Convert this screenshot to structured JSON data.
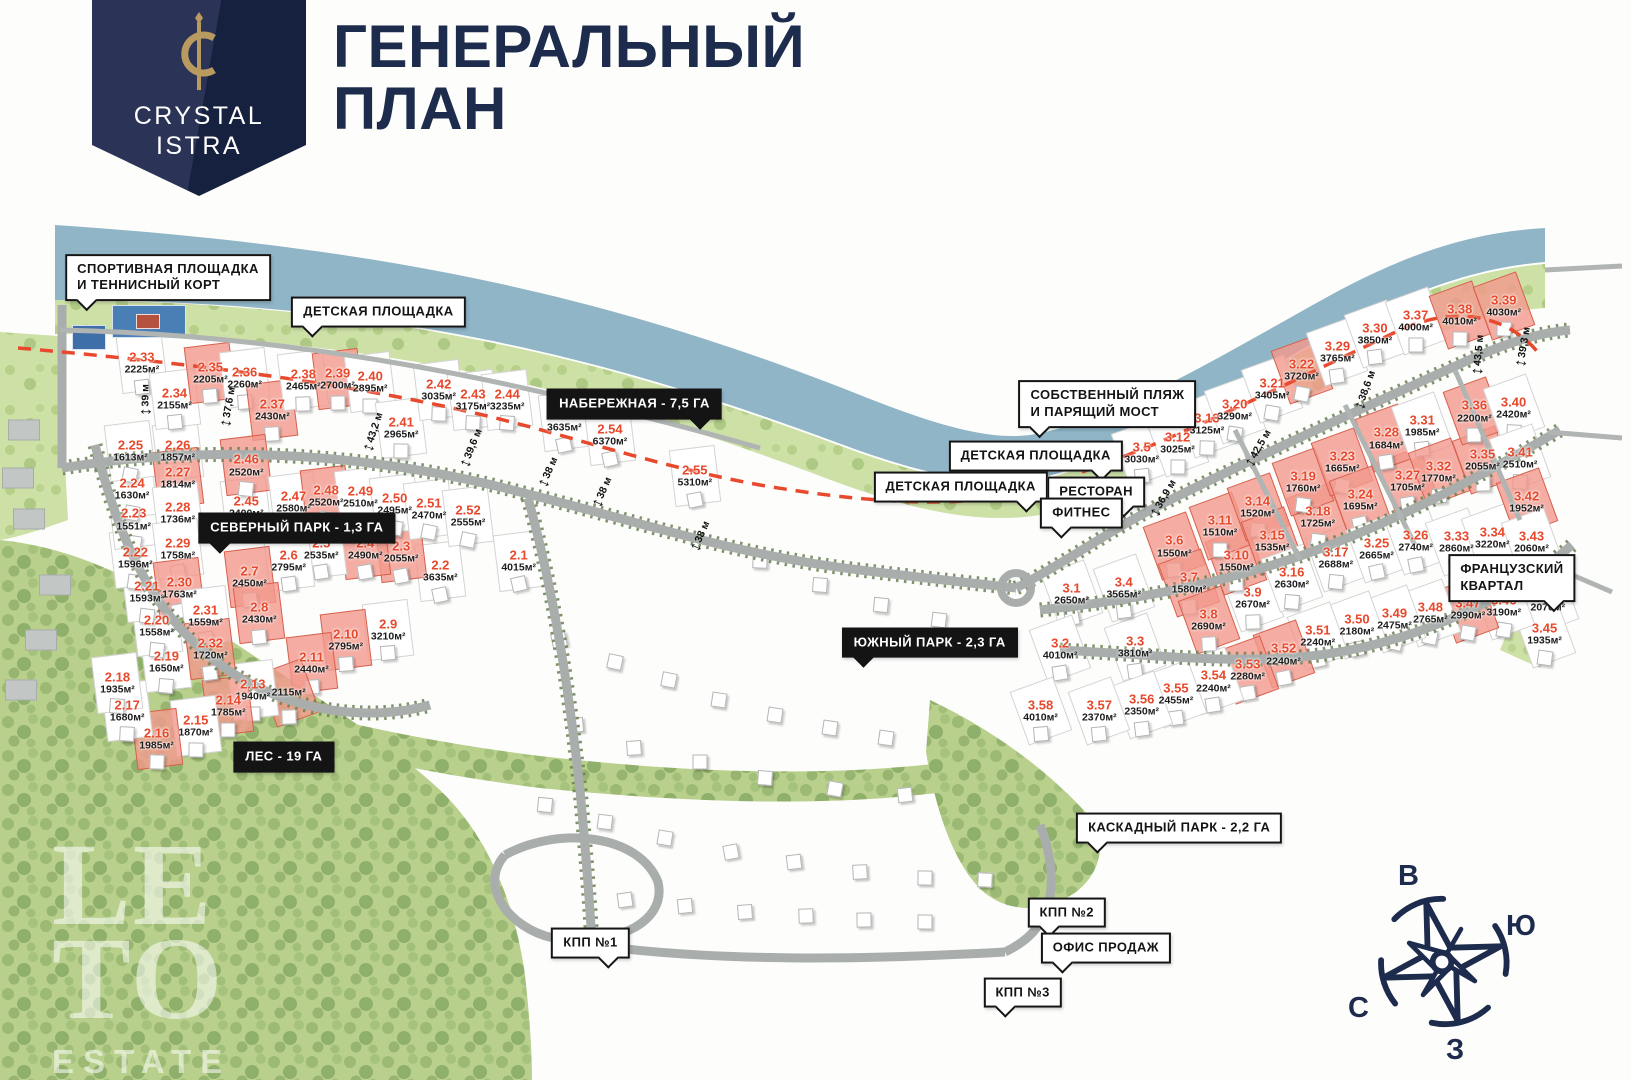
{
  "header": {
    "logo_line1": "CRYSTAL",
    "logo_line2": "ISTRA",
    "title_line1": "ГЕНЕРАЛЬНЫЙ",
    "title_line2": "ПЛАН"
  },
  "watermark": {
    "line1": "LE",
    "line2": "TO",
    "line3": "ESTATE"
  },
  "compass": {
    "top": "В",
    "right": "Ю",
    "left": "С",
    "bottom": "З"
  },
  "colors": {
    "navy": "#1d2b4d",
    "accent_red": "#e8482b",
    "sold_pink": "#f2988c",
    "water": "#8fb5c6",
    "forest": "#b7cf8c",
    "road": "#a9aeac",
    "label_black": "#141414"
  },
  "callouts": [
    {
      "text": "СПОРТИВНАЯ ПЛОЩАДКА\nИ ТЕННИСНЫЙ КОРТ",
      "x": 10.3,
      "y": 25.7,
      "style": "light",
      "pointer": "dl"
    },
    {
      "text": "ДЕТСКАЯ ПЛОЩАДКА",
      "x": 23.2,
      "y": 28.9,
      "style": "light",
      "pointer": "dl"
    },
    {
      "text": "НАБЕРЕЖНАЯ - 7,5 ГА",
      "x": 38.9,
      "y": 37.4,
      "style": "dark",
      "pointer": "dr"
    },
    {
      "text": "СЕВЕРНЫЙ ПАРК - 1,3 ГА",
      "x": 18.2,
      "y": 48.9,
      "style": "dark",
      "pointer": "dl"
    },
    {
      "text": "СОБСТВЕННЫЙ ПЛЯЖ\nИ ПАРЯЩИЙ МОСТ",
      "x": 67.9,
      "y": 37.4,
      "style": "light",
      "pointer": "dl"
    },
    {
      "text": "ДЕТСКАЯ ПЛОЩАДКА",
      "x": 63.5,
      "y": 42.2,
      "style": "light",
      "pointer": "dr"
    },
    {
      "text": "ДЕТСКАЯ ПЛОЩАДКА",
      "x": 58.9,
      "y": 45.1,
      "style": "light",
      "pointer": "dr"
    },
    {
      "text": "РЕСТОРАН",
      "x": 67.2,
      "y": 45.6,
      "style": "light",
      "pointer": "dr"
    },
    {
      "text": "ФИТНЕС",
      "x": 66.3,
      "y": 47.5,
      "style": "light",
      "pointer": "dl"
    },
    {
      "text": "ЮЖНЫЙ ПАРК - 2,3 ГА",
      "x": 57.0,
      "y": 59.5,
      "style": "dark",
      "pointer": "dl"
    },
    {
      "text": "ФРАНЦУЗСКИЙ КВАРТАЛ",
      "x": 92.7,
      "y": 53.5,
      "style": "light",
      "pointer": "dr"
    },
    {
      "text": "ЛЕС - 19 ГА",
      "x": 17.4,
      "y": 70.1,
      "style": "dark",
      "pointer": ""
    },
    {
      "text": "КАСКАДНЫЙ ПАРК - 2,2 ГА",
      "x": 72.3,
      "y": 76.7,
      "style": "light",
      "pointer": "dl"
    },
    {
      "text": "КПП №2",
      "x": 65.4,
      "y": 84.5,
      "style": "light",
      "pointer": "dl"
    },
    {
      "text": "ОФИС ПРОДАЖ",
      "x": 67.8,
      "y": 87.8,
      "style": "light",
      "pointer": "dl"
    },
    {
      "text": "КПП №3",
      "x": 62.7,
      "y": 91.9,
      "style": "light",
      "pointer": "dl"
    },
    {
      "text": "КПП №1",
      "x": 36.2,
      "y": 87.3,
      "style": "light",
      "pointer": "dr"
    }
  ],
  "dimensions": [
    {
      "text": "39 м",
      "x": 8.9,
      "y": 37.0,
      "angle": -90
    },
    {
      "text": "37,6 м",
      "x": 14.0,
      "y": 37.7,
      "angle": -80
    },
    {
      "text": "43,2 м",
      "x": 22.9,
      "y": 40.0,
      "angle": -72
    },
    {
      "text": "39,6 м",
      "x": 28.9,
      "y": 41.5,
      "angle": -68
    },
    {
      "text": "38 м",
      "x": 33.6,
      "y": 43.7,
      "angle": -66
    },
    {
      "text": "38 м",
      "x": 36.9,
      "y": 45.6,
      "angle": -66
    },
    {
      "text": "38 м",
      "x": 42.9,
      "y": 49.6,
      "angle": -66
    },
    {
      "text": "38,6 м",
      "x": 83.7,
      "y": 36.1,
      "angle": -70
    },
    {
      "text": "42,5 м",
      "x": 77.1,
      "y": 41.5,
      "angle": -60
    },
    {
      "text": "36,9 м",
      "x": 71.3,
      "y": 46.1,
      "angle": -60
    },
    {
      "text": "43,5 м",
      "x": 90.6,
      "y": 32.9,
      "angle": -85
    },
    {
      "text": "39,3 м",
      "x": 93.4,
      "y": 32.1,
      "angle": -80
    }
  ],
  "plots": [
    {
      "id": "2.1",
      "area": "4015м²",
      "x": 31.8,
      "y": 51.9,
      "sold": false
    },
    {
      "id": "2.2",
      "area": "3635м²",
      "x": 27.0,
      "y": 52.9,
      "sold": false
    },
    {
      "id": "2.3",
      "area": "2055м²",
      "x": 24.6,
      "y": 51.1,
      "sold": true
    },
    {
      "id": "2.4",
      "area": "2490м²",
      "x": 22.4,
      "y": 50.8,
      "sold": true
    },
    {
      "id": "2.5",
      "area": "2535м²",
      "x": 19.7,
      "y": 50.8,
      "sold": false
    },
    {
      "id": "2.6",
      "area": "2795м²",
      "x": 17.7,
      "y": 51.9,
      "sold": false
    },
    {
      "id": "2.7",
      "area": "2450м²",
      "x": 15.3,
      "y": 53.4,
      "sold": true
    },
    {
      "id": "2.8",
      "area": "2430м²",
      "x": 15.9,
      "y": 56.8,
      "sold": true
    },
    {
      "id": "2.9",
      "area": "3210м²",
      "x": 23.8,
      "y": 58.3,
      "sold": false
    },
    {
      "id": "2.10",
      "area": "2795м²",
      "x": 21.2,
      "y": 59.3,
      "sold": true
    },
    {
      "id": "2.11",
      "area": "2440м²",
      "x": 19.1,
      "y": 61.4,
      "sold": true
    },
    {
      "id": "",
      "area": "2115м²",
      "x": 17.7,
      "y": 64.2,
      "sold": true
    },
    {
      "id": "2.13",
      "area": "1940м²",
      "x": 15.5,
      "y": 63.9,
      "sold": false
    },
    {
      "id": "2.14",
      "area": "1785м²",
      "x": 14.0,
      "y": 65.4,
      "sold": true
    },
    {
      "id": "2.15",
      "area": "1870м²",
      "x": 12.0,
      "y": 67.2,
      "sold": false
    },
    {
      "id": "2.16",
      "area": "1985м²",
      "x": 9.6,
      "y": 68.4,
      "sold": true
    },
    {
      "id": "2.17",
      "area": "1680м²",
      "x": 7.8,
      "y": 65.8,
      "sold": false
    },
    {
      "id": "2.18",
      "area": "1935м²",
      "x": 7.2,
      "y": 63.2,
      "sold": false
    },
    {
      "id": "2.19",
      "area": "1650м²",
      "x": 10.2,
      "y": 61.3,
      "sold": false
    },
    {
      "id": "2.20",
      "area": "1558м²",
      "x": 9.6,
      "y": 58.0,
      "sold": false
    },
    {
      "id": "2.21",
      "area": "1593м²",
      "x": 9.0,
      "y": 54.8,
      "sold": false
    },
    {
      "id": "2.22",
      "area": "1596м²",
      "x": 8.3,
      "y": 51.7,
      "sold": false
    },
    {
      "id": "2.23",
      "area": "1551м²",
      "x": 8.2,
      "y": 48.1,
      "sold": false
    },
    {
      "id": "2.24",
      "area": "1630м²",
      "x": 8.1,
      "y": 45.3,
      "sold": false
    },
    {
      "id": "2.25",
      "area": "1613м²",
      "x": 8.0,
      "y": 41.8,
      "sold": false
    },
    {
      "id": "2.26",
      "area": "1857м²",
      "x": 10.9,
      "y": 41.8,
      "sold": false
    },
    {
      "id": "2.27",
      "area": "1814м²",
      "x": 10.9,
      "y": 44.3,
      "sold": true
    },
    {
      "id": "2.28",
      "area": "1736м²",
      "x": 10.9,
      "y": 47.5,
      "sold": false
    },
    {
      "id": "2.29",
      "area": "1758м²",
      "x": 10.9,
      "y": 50.8,
      "sold": false
    },
    {
      "id": "2.30",
      "area": "1763м²",
      "x": 11.0,
      "y": 54.4,
      "sold": true
    },
    {
      "id": "2.31",
      "area": "1559м²",
      "x": 12.6,
      "y": 57.0,
      "sold": false
    },
    {
      "id": "2.32",
      "area": "1720м²",
      "x": 12.9,
      "y": 60.1,
      "sold": true
    },
    {
      "id": "2.33",
      "area": "2225м²",
      "x": 8.7,
      "y": 33.6,
      "sold": false
    },
    {
      "id": "2.34",
      "area": "2155м²",
      "x": 10.7,
      "y": 36.9,
      "sold": false
    },
    {
      "id": "2.35",
      "area": "2205м²",
      "x": 12.9,
      "y": 34.5,
      "sold": true
    },
    {
      "id": "2.36",
      "area": "2260м²",
      "x": 15.0,
      "y": 35.0,
      "sold": false
    },
    {
      "id": "2.37",
      "area": "2430м²",
      "x": 16.7,
      "y": 38.0,
      "sold": true
    },
    {
      "id": "2.38",
      "area": "2465м²",
      "x": 18.6,
      "y": 35.2,
      "sold": false
    },
    {
      "id": "2.39",
      "area": "2700м²",
      "x": 20.7,
      "y": 35.1,
      "sold": true
    },
    {
      "id": "2.40",
      "area": "2895м²",
      "x": 22.7,
      "y": 35.4,
      "sold": false
    },
    {
      "id": "2.41",
      "area": "2965м²",
      "x": 24.6,
      "y": 39.6,
      "sold": false
    },
    {
      "id": "2.42",
      "area": "3035м²",
      "x": 26.9,
      "y": 36.1,
      "sold": false
    },
    {
      "id": "2.43",
      "area": "3175м²",
      "x": 29.0,
      "y": 37.0,
      "sold": false
    },
    {
      "id": "2.44",
      "area": "3235м²",
      "x": 31.1,
      "y": 37.0,
      "sold": false
    },
    {
      "id": "2.45",
      "area": "2400м²",
      "x": 15.1,
      "y": 46.9,
      "sold": false
    },
    {
      "id": "2.46",
      "area": "2520м²",
      "x": 15.1,
      "y": 43.1,
      "sold": true
    },
    {
      "id": "2.47",
      "area": "2580м²",
      "x": 18.0,
      "y": 46.5,
      "sold": false
    },
    {
      "id": "2.48",
      "area": "2520м²",
      "x": 20.0,
      "y": 45.9,
      "sold": true
    },
    {
      "id": "2.49",
      "area": "2510м²",
      "x": 22.1,
      "y": 46.0,
      "sold": false
    },
    {
      "id": "2.50",
      "area": "2495м²",
      "x": 24.2,
      "y": 46.7,
      "sold": false
    },
    {
      "id": "2.51",
      "area": "2470м²",
      "x": 26.3,
      "y": 47.1,
      "sold": false
    },
    {
      "id": "2.52",
      "area": "2555м²",
      "x": 28.7,
      "y": 47.8,
      "sold": false
    },
    {
      "id": "2.53",
      "area": "3635м²",
      "x": 34.6,
      "y": 39.0,
      "sold": false
    },
    {
      "id": "2.54",
      "area": "6370м²",
      "x": 37.4,
      "y": 40.3,
      "sold": false
    },
    {
      "id": "2.55",
      "area": "5310м²",
      "x": 42.6,
      "y": 44.1,
      "sold": false
    },
    {
      "id": "3.1",
      "area": "2650м²",
      "x": 65.7,
      "y": 55.0,
      "sold": false
    },
    {
      "id": "3.2",
      "area": "4010м²",
      "x": 65.0,
      "y": 60.1,
      "sold": false
    },
    {
      "id": "3.3",
      "area": "3810м²",
      "x": 69.6,
      "y": 59.9,
      "sold": false
    },
    {
      "id": "3.4",
      "area": "3565м²",
      "x": 68.9,
      "y": 54.4,
      "sold": false
    },
    {
      "id": "3.5",
      "area": "3030м²",
      "x": 70.0,
      "y": 41.9,
      "sold": false
    },
    {
      "id": "3.6",
      "area": "1550м²",
      "x": 72.0,
      "y": 50.6,
      "sold": true
    },
    {
      "id": "3.7",
      "area": "1580м²",
      "x": 72.9,
      "y": 54.0,
      "sold": true
    },
    {
      "id": "3.8",
      "area": "2690м²",
      "x": 74.1,
      "y": 57.4,
      "sold": true
    },
    {
      "id": "3.9",
      "area": "2670м²",
      "x": 76.8,
      "y": 55.4,
      "sold": false
    },
    {
      "id": "3.10",
      "area": "1550м²",
      "x": 75.8,
      "y": 51.9,
      "sold": true
    },
    {
      "id": "3.11",
      "area": "1510м²",
      "x": 74.8,
      "y": 48.7,
      "sold": true
    },
    {
      "id": "3.12",
      "area": "3025м²",
      "x": 72.2,
      "y": 41.0,
      "sold": false
    },
    {
      "id": "3.13",
      "area": "3125м²",
      "x": 74.0,
      "y": 39.3,
      "sold": false
    },
    {
      "id": "3.14",
      "area": "1520м²",
      "x": 77.1,
      "y": 46.9,
      "sold": true
    },
    {
      "id": "3.15",
      "area": "1535м²",
      "x": 78.0,
      "y": 50.1,
      "sold": true
    },
    {
      "id": "3.16",
      "area": "2630м²",
      "x": 79.2,
      "y": 53.5,
      "sold": false
    },
    {
      "id": "3.17",
      "area": "2688м²",
      "x": 81.9,
      "y": 51.7,
      "sold": false
    },
    {
      "id": "3.18",
      "area": "1725м²",
      "x": 80.8,
      "y": 47.9,
      "sold": true
    },
    {
      "id": "3.19",
      "area": "1760м²",
      "x": 79.9,
      "y": 44.6,
      "sold": true
    },
    {
      "id": "3.20",
      "area": "3290м²",
      "x": 75.7,
      "y": 38.0,
      "sold": false
    },
    {
      "id": "3.21",
      "area": "3405м²",
      "x": 78.0,
      "y": 36.0,
      "sold": false
    },
    {
      "id": "3.22",
      "area": "3720м²",
      "x": 79.8,
      "y": 34.3,
      "sold": true
    },
    {
      "id": "3.23",
      "area": "1665м²",
      "x": 82.3,
      "y": 42.8,
      "sold": true
    },
    {
      "id": "3.24",
      "area": "1695м²",
      "x": 83.4,
      "y": 46.3,
      "sold": true
    },
    {
      "id": "3.25",
      "area": "2665м²",
      "x": 84.4,
      "y": 50.8,
      "sold": false
    },
    {
      "id": "3.26",
      "area": "2740м²",
      "x": 86.8,
      "y": 50.1,
      "sold": false
    },
    {
      "id": "3.27",
      "area": "1705м²",
      "x": 86.3,
      "y": 44.5,
      "sold": true
    },
    {
      "id": "3.28",
      "area": "1684м²",
      "x": 85.0,
      "y": 40.6,
      "sold": true
    },
    {
      "id": "3.29",
      "area": "3765м²",
      "x": 82.0,
      "y": 32.6,
      "sold": false
    },
    {
      "id": "3.30",
      "area": "3850м²",
      "x": 84.3,
      "y": 30.9,
      "sold": false
    },
    {
      "id": "3.31",
      "area": "1985м²",
      "x": 87.2,
      "y": 39.4,
      "sold": false
    },
    {
      "id": "3.32",
      "area": "1770м²",
      "x": 88.2,
      "y": 43.7,
      "sold": true
    },
    {
      "id": "3.33",
      "area": "2860м²",
      "x": 89.3,
      "y": 50.2,
      "sold": false
    },
    {
      "id": "3.34",
      "area": "3220м²",
      "x": 91.5,
      "y": 49.8,
      "sold": false
    },
    {
      "id": "3.35",
      "area": "2055м²",
      "x": 90.9,
      "y": 42.6,
      "sold": true
    },
    {
      "id": "3.36",
      "area": "2200м²",
      "x": 90.4,
      "y": 38.1,
      "sold": true
    },
    {
      "id": "3.37",
      "area": "4000м²",
      "x": 86.8,
      "y": 29.7,
      "sold": false
    },
    {
      "id": "3.38",
      "area": "4010м²",
      "x": 89.5,
      "y": 29.2,
      "sold": true
    },
    {
      "id": "3.39",
      "area": "4030м²",
      "x": 92.2,
      "y": 28.3,
      "sold": true
    },
    {
      "id": "3.40",
      "area": "2420м²",
      "x": 92.8,
      "y": 37.8,
      "sold": false
    },
    {
      "id": "3.41",
      "area": "2510м²",
      "x": 93.2,
      "y": 42.4,
      "sold": false
    },
    {
      "id": "3.42",
      "area": "1952м²",
      "x": 93.6,
      "y": 46.5,
      "sold": true
    },
    {
      "id": "3.43",
      "area": "2060м²",
      "x": 93.9,
      "y": 50.2,
      "sold": false
    },
    {
      "id": "3.44",
      "area": "2070м²",
      "x": 94.9,
      "y": 55.6,
      "sold": false
    },
    {
      "id": "3.45",
      "area": "1935м²",
      "x": 94.7,
      "y": 58.7,
      "sold": false
    },
    {
      "id": "3.46",
      "area": "3190м²",
      "x": 92.2,
      "y": 56.1,
      "sold": false
    },
    {
      "id": "3.47",
      "area": "2990м²",
      "x": 90.0,
      "y": 56.4,
      "sold": true
    },
    {
      "id": "3.48",
      "area": "2765м²",
      "x": 87.7,
      "y": 56.8,
      "sold": false
    },
    {
      "id": "3.49",
      "area": "2475м²",
      "x": 85.5,
      "y": 57.3,
      "sold": false
    },
    {
      "id": "3.50",
      "area": "2180м²",
      "x": 83.2,
      "y": 57.9,
      "sold": false
    },
    {
      "id": "3.51",
      "area": "2240м²",
      "x": 80.8,
      "y": 58.9,
      "sold": false
    },
    {
      "id": "3.52",
      "area": "2240м²",
      "x": 78.7,
      "y": 60.6,
      "sold": true
    },
    {
      "id": "3.53",
      "area": "2280м²",
      "x": 76.5,
      "y": 62.0,
      "sold": true
    },
    {
      "id": "3.54",
      "area": "2240м²",
      "x": 74.4,
      "y": 63.1,
      "sold": false
    },
    {
      "id": "3.55",
      "area": "2455м²",
      "x": 72.1,
      "y": 64.3,
      "sold": false
    },
    {
      "id": "3.56",
      "area": "2350м²",
      "x": 70.0,
      "y": 65.3,
      "sold": false
    },
    {
      "id": "3.57",
      "area": "2370м²",
      "x": 67.4,
      "y": 65.8,
      "sold": false
    },
    {
      "id": "3.58",
      "area": "4010м²",
      "x": 63.8,
      "y": 65.8,
      "sold": false
    }
  ],
  "decor_houses": [
    {
      "x": 34.3,
      "y": 59.3
    },
    {
      "x": 37.7,
      "y": 61.3
    },
    {
      "x": 41.0,
      "y": 63.0
    },
    {
      "x": 44.1,
      "y": 64.8
    },
    {
      "x": 47.5,
      "y": 66.2
    },
    {
      "x": 50.9,
      "y": 67.4
    },
    {
      "x": 54.3,
      "y": 68.3
    },
    {
      "x": 35.3,
      "y": 67.1
    },
    {
      "x": 38.9,
      "y": 69.3
    },
    {
      "x": 42.9,
      "y": 70.6
    },
    {
      "x": 46.9,
      "y": 72.0
    },
    {
      "x": 51.2,
      "y": 73.1
    },
    {
      "x": 55.5,
      "y": 73.6
    },
    {
      "x": 33.4,
      "y": 74.5
    },
    {
      "x": 37.1,
      "y": 76.1
    },
    {
      "x": 40.8,
      "y": 77.6
    },
    {
      "x": 44.8,
      "y": 78.9
    },
    {
      "x": 48.7,
      "y": 79.8
    },
    {
      "x": 52.7,
      "y": 80.7
    },
    {
      "x": 56.7,
      "y": 81.3
    },
    {
      "x": 60.4,
      "y": 81.5
    },
    {
      "x": 38.3,
      "y": 83.3
    },
    {
      "x": 42.0,
      "y": 83.9
    },
    {
      "x": 45.7,
      "y": 84.4
    },
    {
      "x": 49.4,
      "y": 84.8
    },
    {
      "x": 53.0,
      "y": 85.2
    },
    {
      "x": 56.7,
      "y": 85.4
    },
    {
      "x": 46.6,
      "y": 51.9
    },
    {
      "x": 50.3,
      "y": 54.2
    },
    {
      "x": 54.0,
      "y": 56.0
    },
    {
      "x": 57.6,
      "y": 57.4
    }
  ],
  "neighbor_buildings": [
    {
      "x": 1.5,
      "y": 39.8
    },
    {
      "x": 1.1,
      "y": 44.3
    },
    {
      "x": 1.8,
      "y": 48.1
    },
    {
      "x": 3.4,
      "y": 54.2
    },
    {
      "x": 2.5,
      "y": 59.3
    },
    {
      "x": 1.3,
      "y": 63.9
    }
  ]
}
